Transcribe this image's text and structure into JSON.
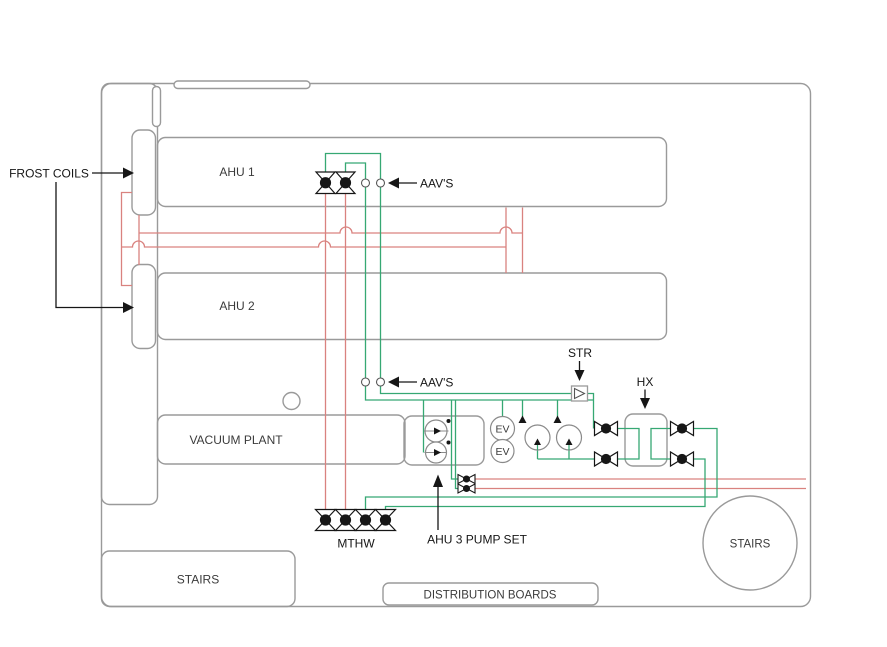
{
  "diagram": {
    "type": "hvac-plant-room-schematic",
    "labels": {
      "frost_coils": "FROST COILS",
      "ahu1": "AHU 1",
      "ahu2": "AHU 2",
      "vacuum_plant": "VACUUM PLANT",
      "stairs_left": "STAIRS",
      "stairs_right": "STAIRS",
      "distribution_boards": "DISTRIBUTION BOARDS",
      "aavs_upper": "AAV'S",
      "aavs_lower": "AAV'S",
      "strainer": "STR",
      "heat_exchanger": "HX",
      "mthw": "MTHW",
      "ahu3_pump_set": "AHU 3 PUMP SET",
      "ev": "EV"
    },
    "colors": {
      "wall": "#9a9a9a",
      "pipe_red": "#d9827f",
      "pipe_green": "#36a873",
      "annotation": "#161616"
    },
    "equipment": [
      "frost-coil",
      "frost-coil",
      "isolation-valve",
      "isolation-valve",
      "air-admittance-valve",
      "air-admittance-valve",
      "air-admittance-valve",
      "air-admittance-valve",
      "strainer",
      "heat-exchanger",
      "expansion-vessel",
      "expansion-vessel",
      "circulating-pump",
      "circulating-pump",
      "circulating-pump",
      "circulating-pump",
      "hx-valve",
      "hx-valve",
      "hx-valve",
      "hx-valve",
      "transition-valve",
      "transition-valve",
      "mthw-valve",
      "mthw-valve",
      "mthw-valve",
      "mthw-valve"
    ]
  }
}
